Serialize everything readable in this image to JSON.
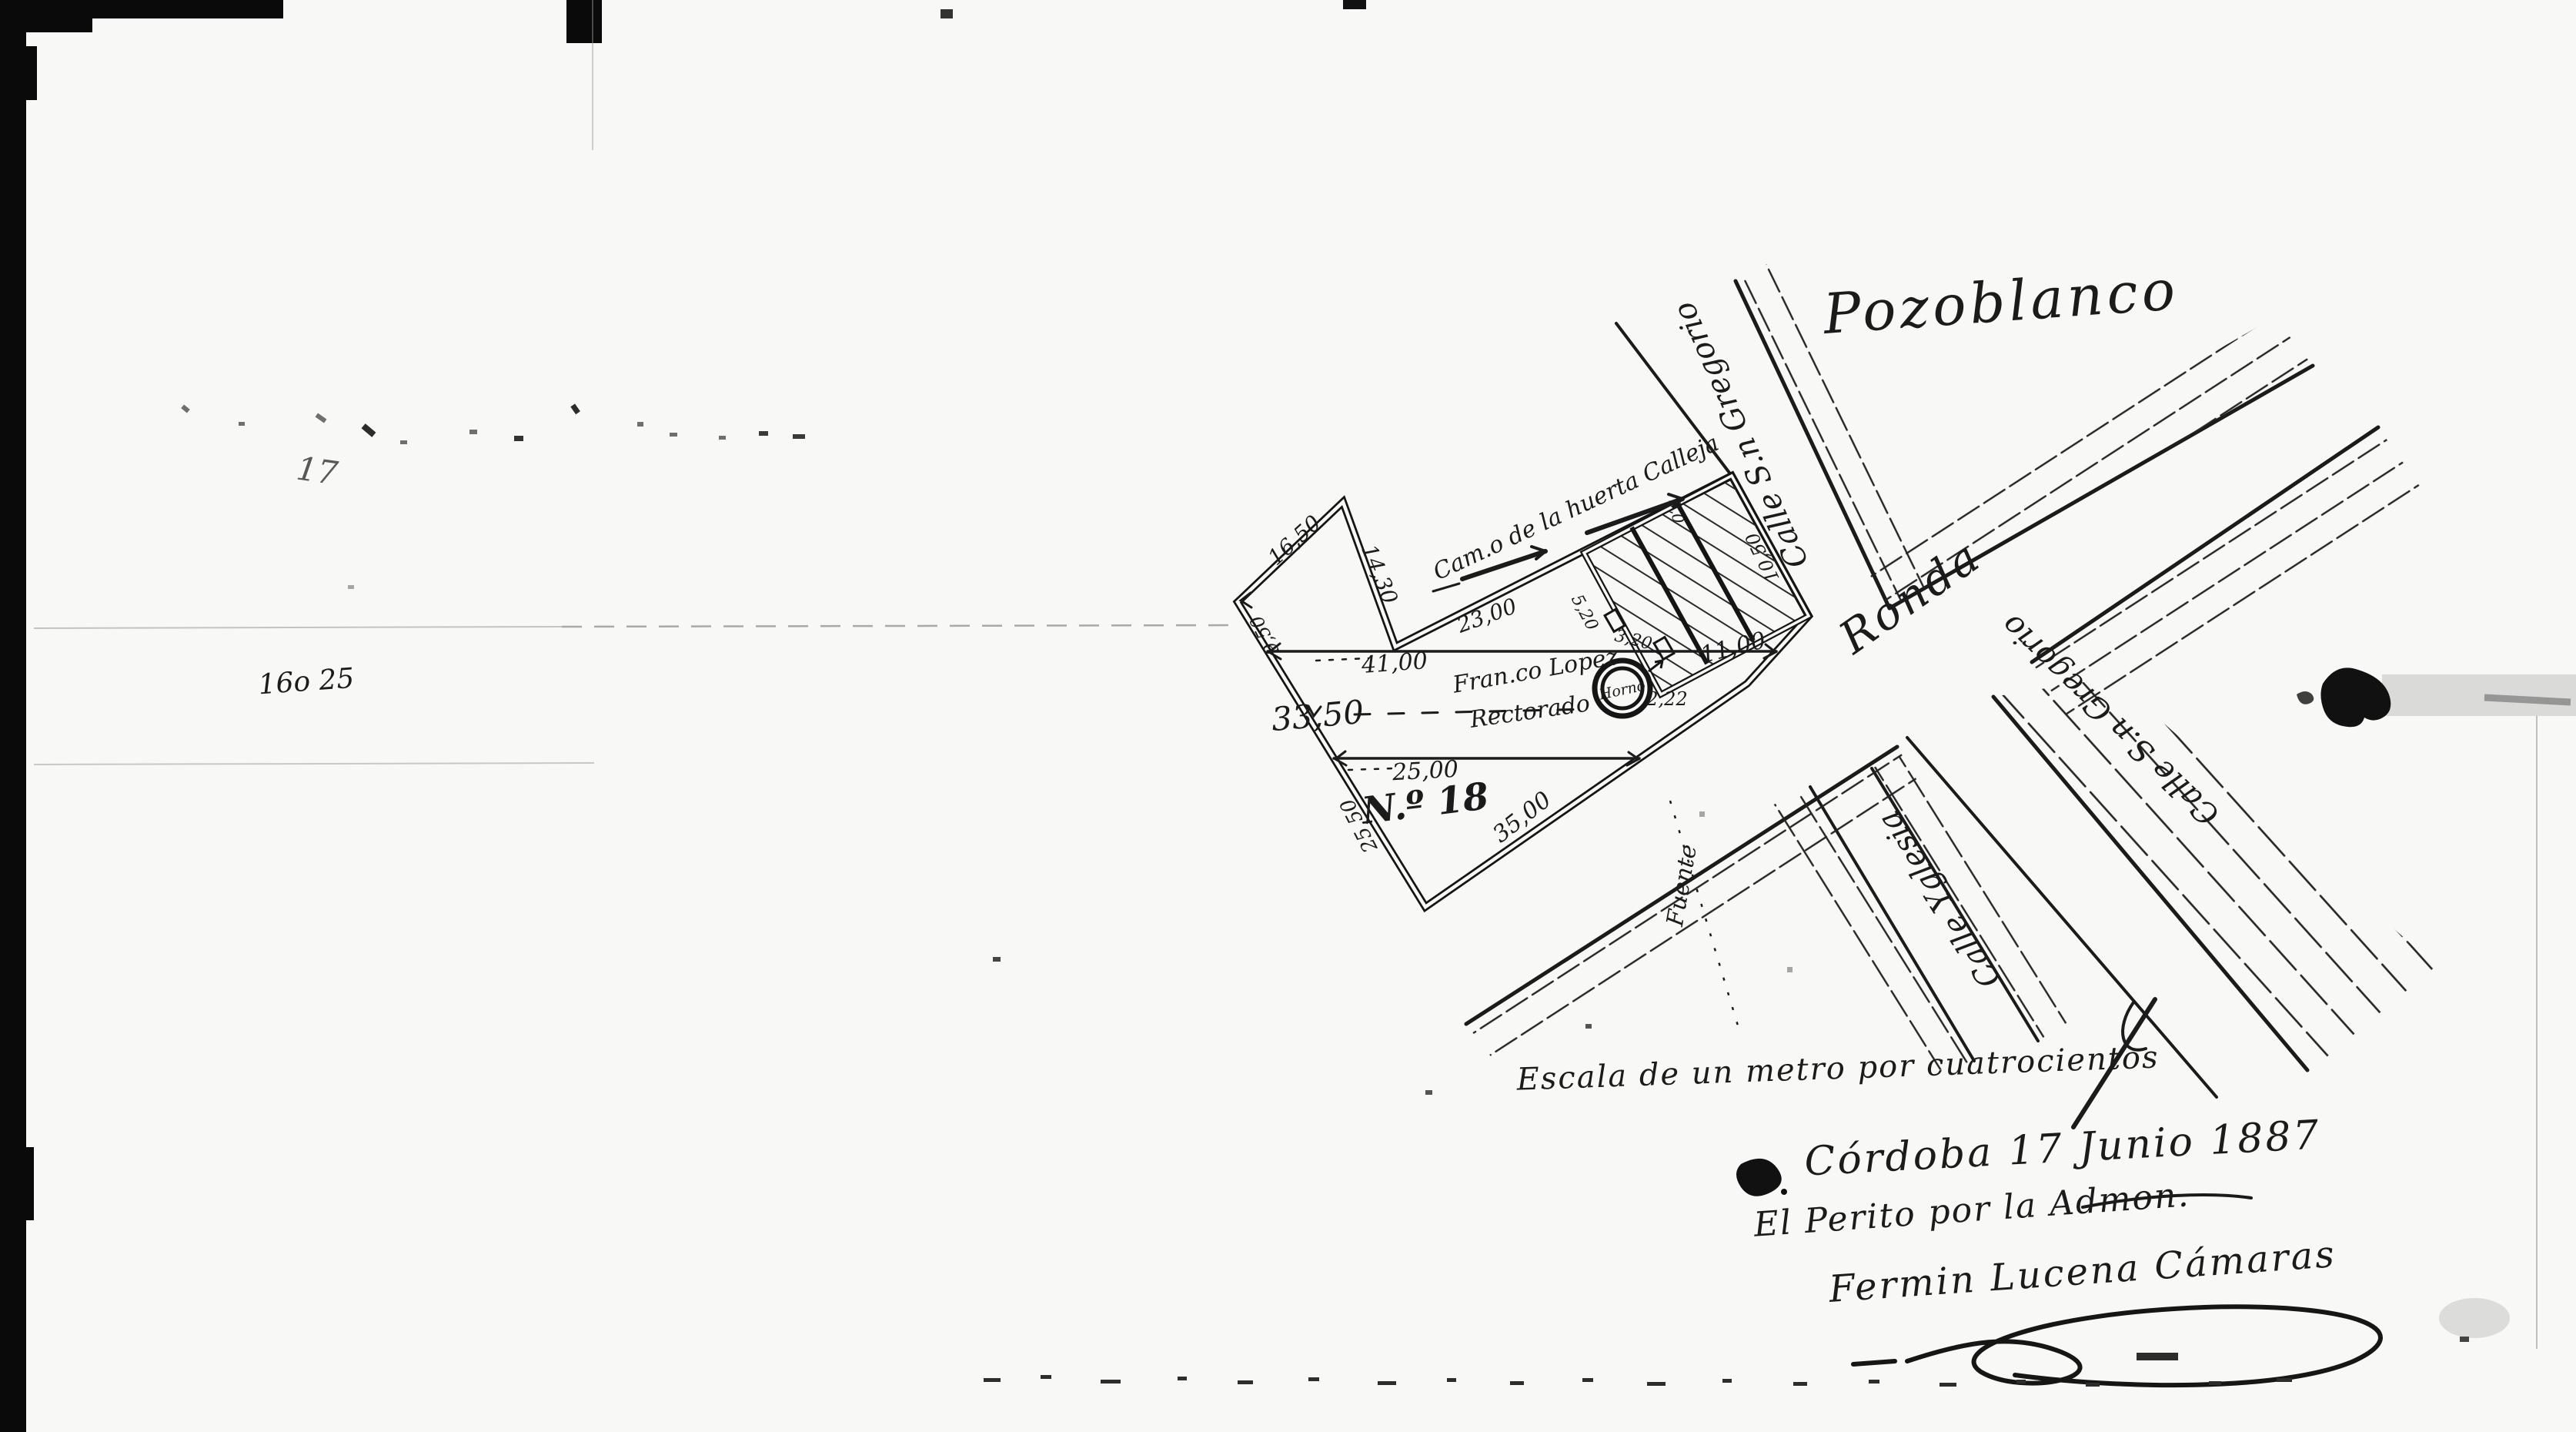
{
  "colors": {
    "paper": "#f8f8f6",
    "ink": "#1b1b1b"
  },
  "corner_annotations": {
    "archive_number": "16o 25",
    "faint_number": "17"
  },
  "town": {
    "direction_label": "Pozoblanco"
  },
  "streets": {
    "ronda": "Ronda",
    "calle_gregorio_upper": "Calle S.n Gregorio",
    "calle_gregorio_lower": "Calle S.n Gregorio",
    "calle_yglesia": "Calle Yglesia",
    "fuente": "Fuente",
    "camino": "Cam.o de la huerta Calleja"
  },
  "parcel": {
    "number": "N.º 18",
    "owner_line1": "Fran.co Lopez",
    "owner_line2": "Rectorado",
    "kiln_label": "Horno",
    "measurements": {
      "m_2_22": "2,22",
      "m_41_00": "41,00",
      "m_33_50": "33,50",
      "m_25_00": "25,00",
      "m_35_00": "35,00",
      "m_25_50": "25,50",
      "m_9_50": "9,50",
      "m_16_50": "16,50",
      "m_14_30": "14,30",
      "m_23_00": "23,00",
      "m_5_20": "5,20",
      "m_3_20": "3,20",
      "m_9_0": "9,0",
      "m_10_50": "10,50",
      "m_11_00": "11,00"
    }
  },
  "footer": {
    "scale_note": "Escala de un metro por cuatrocientos",
    "place_date": "Córdoba 17 Junio 1887",
    "surveyor_title": "El Perito por la Admon.",
    "signature": "Fermin Lucena Cámaras"
  }
}
